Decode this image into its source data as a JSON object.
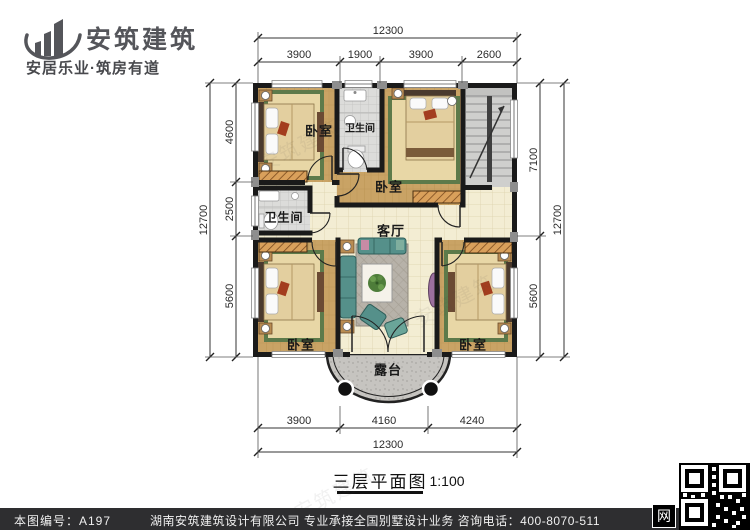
{
  "header": {
    "logo_text": "安筑建筑",
    "tagline": "安居乐业·筑房有道"
  },
  "plan": {
    "rooms": [
      {
        "id": "bedroom-top-left",
        "label": "卧室"
      },
      {
        "id": "bathroom-top",
        "label": "卫生间"
      },
      {
        "id": "bedroom-middle",
        "label": "卧室"
      },
      {
        "id": "bathroom-left",
        "label": "卫生间"
      },
      {
        "id": "living-room",
        "label": "客厅"
      },
      {
        "id": "bedroom-bottom-left",
        "label": "卧室"
      },
      {
        "id": "bedroom-bottom-right",
        "label": "卧室"
      },
      {
        "id": "terrace",
        "label": "露台"
      }
    ],
    "dimensions": {
      "top_total": "12300",
      "top_segments": [
        "3900",
        "1900",
        "3900",
        "2600"
      ],
      "left_total": "12700",
      "left_segments": [
        "4600",
        "2500",
        "5600"
      ],
      "right_total": "12700",
      "right_segments": [
        "7100",
        "5600"
      ],
      "bottom_total": "12300",
      "bottom_segments": [
        "3900",
        "4160",
        "4240"
      ]
    }
  },
  "title": {
    "text": "三层平面图",
    "scale": "1:100"
  },
  "footer": {
    "drawing_no": "本图编号：A197",
    "company_line": "湖南安筑建筑设计有限公司  专业承接全国别墅设计业务  咨询电话：400-8070-511",
    "web_char": "网"
  },
  "watermark": {
    "text": "安筑建筑"
  },
  "colors": {
    "wall": "#1a1a1a",
    "wood_floor": "#c9a365",
    "tile_floor": "#f3edd3",
    "bath_floor": "#dcdcda",
    "terrace_floor": "#c6c4c0",
    "sofa": "#55908a",
    "carpet_border": "#5d7a4a",
    "footer_bg": "#2e2e30",
    "logo_gray": "#54555a"
  }
}
